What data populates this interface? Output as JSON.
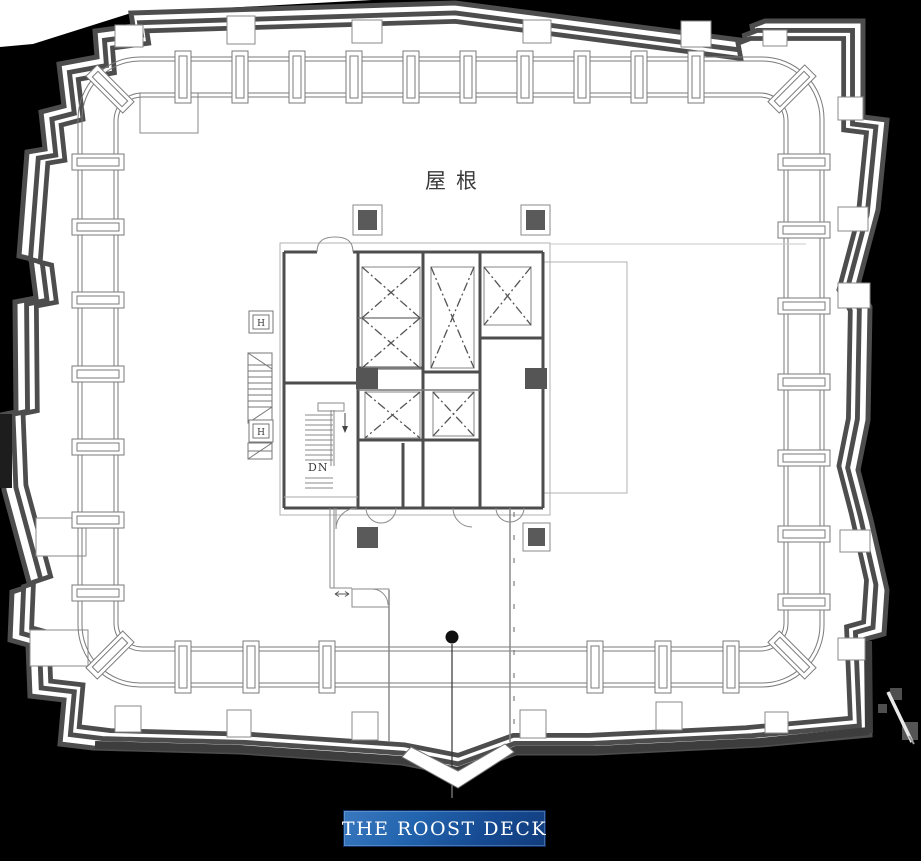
{
  "page": {
    "background_color": "#000000",
    "plan_fill_color": "#ffffff",
    "outline_color": "#4d4d4d",
    "rail_color": "#7a7a7a",
    "wall_color": "#4d4d4d",
    "column_fill_color": "#555555"
  },
  "plan": {
    "roof_label": "屋根",
    "stairs": {
      "down_label": "DN"
    },
    "hydrant_boxes": [
      "H",
      "H"
    ]
  },
  "badge": {
    "label": "THE ROOST DECK",
    "bg_gradient_from": "#3a78be",
    "bg_gradient_to": "#113c7c",
    "text_color": "#ffffff",
    "border_color": "#0b2d61"
  }
}
